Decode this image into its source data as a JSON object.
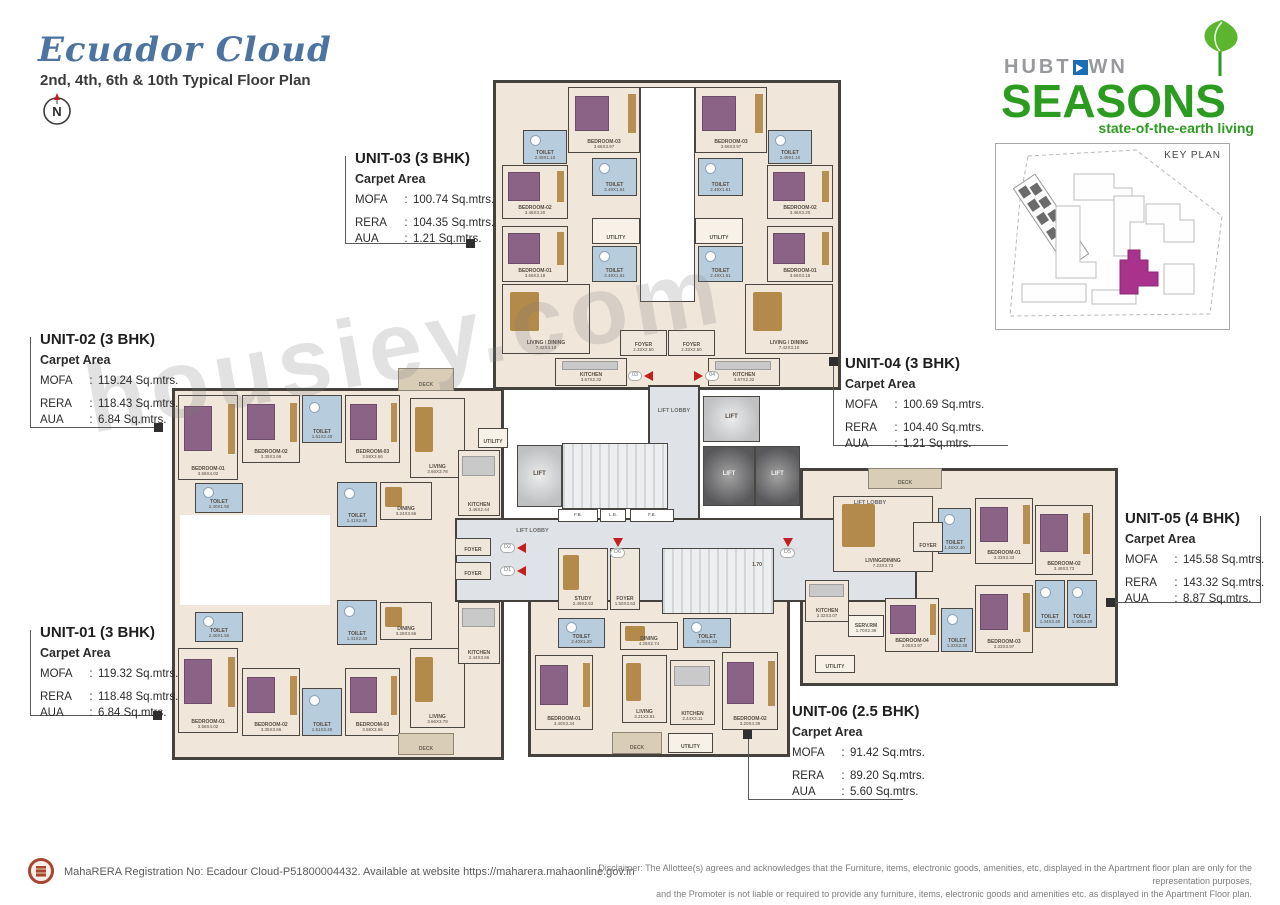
{
  "header": {
    "title": "Ecuador Cloud",
    "subtitle": "2nd, 4th, 6th & 10th Typical Floor Plan",
    "compass": "N"
  },
  "logo": {
    "brand": "HUBT",
    "brand2": "WN",
    "product": "SEASONS",
    "tagline": "state-of-the-earth living"
  },
  "keyplan": {
    "label": "KEY PLAN"
  },
  "watermark": "housiey.com",
  "units": [
    {
      "id": "unit-01",
      "name": "UNIT-01 (3 BHK)",
      "carpet": "Carpet Area",
      "rows": [
        [
          "MOFA",
          "119.32 Sq.mtrs."
        ],
        [
          "RERA",
          "118.48 Sq.mtrs."
        ],
        [
          "AUA",
          "6.84 Sq.mtrs."
        ]
      ],
      "x": 40,
      "y": 624,
      "lines": [
        [
          30,
          630,
          1,
          86
        ],
        [
          30,
          715,
          128,
          1
        ]
      ],
      "marker": [
        153,
        711
      ]
    },
    {
      "id": "unit-02",
      "name": "UNIT-02 (3 BHK)",
      "carpet": "Carpet Area",
      "rows": [
        [
          "MOFA",
          "119.24 Sq.mtrs."
        ],
        [
          "RERA",
          "118.43 Sq.mtrs."
        ],
        [
          "AUA",
          "6.84 Sq.mtrs."
        ]
      ],
      "x": 40,
      "y": 331,
      "lines": [
        [
          30,
          337,
          1,
          91
        ],
        [
          30,
          427,
          129,
          1
        ]
      ],
      "marker": [
        154,
        423
      ]
    },
    {
      "id": "unit-03",
      "name": "UNIT-03 (3 BHK)",
      "carpet": "Carpet Area",
      "rows": [
        [
          "MOFA",
          "100.74 Sq.mtrs."
        ],
        [
          "RERA",
          "104.35 Sq.mtrs."
        ],
        [
          "AUA",
          "1.21 Sq.mtrs."
        ]
      ],
      "x": 355,
      "y": 150,
      "lines": [
        [
          345,
          156,
          1,
          88
        ],
        [
          345,
          243,
          125,
          1
        ]
      ],
      "marker": [
        466,
        239
      ]
    },
    {
      "id": "unit-04",
      "name": "UNIT-04 (3 BHK)",
      "carpet": "Carpet Area",
      "rows": [
        [
          "MOFA",
          "100.69 Sq.mtrs."
        ],
        [
          "RERA",
          "104.40 Sq.mtrs."
        ],
        [
          "AUA",
          "1.21 Sq.mtrs."
        ]
      ],
      "x": 845,
      "y": 355,
      "lines": [
        [
          833,
          362,
          1,
          84
        ],
        [
          833,
          445,
          175,
          1
        ]
      ],
      "marker": [
        829,
        357
      ]
    },
    {
      "id": "unit-05",
      "name": "UNIT-05 (4 BHK)",
      "carpet": "Carpet Area",
      "rows": [
        [
          "MOFA",
          "145.58 Sq.mtrs."
        ],
        [
          "RERA",
          "143.32 Sq.mtrs."
        ],
        [
          "AUA",
          "8.87 Sq.mtrs."
        ]
      ],
      "x": 1125,
      "y": 510,
      "lines": [
        [
          1260,
          516,
          1,
          87
        ],
        [
          1112,
          602,
          149,
          1
        ]
      ],
      "marker": [
        1106,
        598
      ]
    },
    {
      "id": "unit-06",
      "name": "UNIT-06 (2.5 BHK)",
      "carpet": "Carpet Area",
      "rows": [
        [
          "MOFA",
          "91.42 Sq.mtrs."
        ],
        [
          "RERA",
          "89.20 Sq.mtrs."
        ],
        [
          "AUA",
          "5.60 Sq.mtrs."
        ]
      ],
      "x": 792,
      "y": 703,
      "lines": [
        [
          748,
          737,
          1,
          63
        ],
        [
          748,
          799,
          155,
          1
        ]
      ],
      "marker": [
        743,
        730
      ]
    }
  ],
  "floorplan": {
    "plates": [
      [
        493,
        80,
        348,
        310,
        "plate"
      ],
      [
        172,
        388,
        332,
        372,
        "plate"
      ],
      [
        800,
        468,
        318,
        218,
        "plate"
      ],
      [
        528,
        595,
        262,
        162,
        "plate"
      ],
      [
        648,
        385,
        52,
        138,
        "lobby"
      ],
      [
        455,
        518,
        462,
        84,
        "lobby"
      ],
      [
        180,
        515,
        150,
        90,
        "cut"
      ]
    ],
    "rooms": [
      [
        "",
        "",
        640,
        87,
        55,
        215,
        "shaft"
      ],
      [
        "BEDROOM-03",
        "3.66X3.97",
        568,
        87,
        72,
        66,
        "bedroom"
      ],
      [
        "TOILET",
        "2.49X1.10",
        523,
        130,
        44,
        34,
        "toilet"
      ],
      [
        "BEDROOM-02",
        "3.46X3.20",
        502,
        165,
        66,
        54,
        "bedroom"
      ],
      [
        "TOILET",
        "2.49X1.61",
        592,
        158,
        45,
        38,
        "toilet"
      ],
      [
        "BEDROOM-01",
        "3.66X3.18",
        502,
        226,
        66,
        56,
        "bedroom"
      ],
      [
        "UTILITY",
        "",
        592,
        218,
        48,
        26,
        "utility"
      ],
      [
        "TOILET",
        "2.49X1.61",
        592,
        246,
        45,
        36,
        "toilet"
      ],
      [
        "LIVING / DINING",
        "7.42X3.10",
        502,
        284,
        88,
        70,
        "living"
      ],
      [
        "FOYER",
        "2.32X2.50",
        620,
        330,
        47,
        26,
        "foyer"
      ],
      [
        "KITCHEN",
        "3.67X2.32",
        555,
        358,
        72,
        28,
        "kitchen"
      ],
      [
        "BEDROOM-03",
        "3.66X3.97",
        695,
        87,
        72,
        66,
        "bedroom"
      ],
      [
        "TOILET",
        "2.49X1.10",
        768,
        130,
        44,
        34,
        "toilet"
      ],
      [
        "BEDROOM-02",
        "3.46X3.20",
        767,
        165,
        66,
        54,
        "bedroom"
      ],
      [
        "TOILET",
        "2.49X1.61",
        698,
        158,
        45,
        38,
        "toilet"
      ],
      [
        "BEDROOM-01",
        "3.66X3.18",
        767,
        226,
        66,
        56,
        "bedroom"
      ],
      [
        "UTILITY",
        "",
        695,
        218,
        48,
        26,
        "utility"
      ],
      [
        "TOILET",
        "2.49X1.61",
        698,
        246,
        45,
        36,
        "toilet"
      ],
      [
        "LIVING / DINING",
        "7.42X3.10",
        745,
        284,
        88,
        70,
        "living"
      ],
      [
        "FOYER",
        "2.32X2.50",
        668,
        330,
        47,
        26,
        "foyer"
      ],
      [
        "KITCHEN",
        "3.67X2.32",
        708,
        358,
        72,
        28,
        "kitchen"
      ],
      [
        "DECK",
        "",
        398,
        368,
        56,
        23,
        "deck"
      ],
      [
        "BEDROOM-01",
        "3.58X4.02",
        178,
        395,
        60,
        85,
        "bedroom"
      ],
      [
        "BEDROOM-02",
        "3.35X3.66",
        242,
        395,
        58,
        68,
        "bedroom"
      ],
      [
        "TOILET",
        "1.51X2.40",
        302,
        395,
        40,
        48,
        "toilet"
      ],
      [
        "BEDROOM-03",
        "3.58X3.66",
        345,
        395,
        55,
        68,
        "bedroom"
      ],
      [
        "LIVING",
        "3.66X3.78",
        410,
        398,
        55,
        80,
        "living"
      ],
      [
        "UTILITY",
        "",
        478,
        428,
        30,
        20,
        "utility"
      ],
      [
        "TOILET",
        "2.40X1.50",
        195,
        483,
        48,
        30,
        "toilet"
      ],
      [
        "TOILET",
        "1.41X2.40",
        337,
        482,
        40,
        45,
        "toilet"
      ],
      [
        "DINING",
        "3.24X3.66",
        380,
        482,
        52,
        38,
        "living"
      ],
      [
        "KITCHEN",
        "3.46X2.44",
        458,
        450,
        42,
        66,
        "kitchen"
      ],
      [
        "FOYER",
        "",
        455,
        538,
        36,
        18,
        "foyer"
      ],
      [
        "FOYER",
        "",
        455,
        562,
        36,
        18,
        "foyer"
      ],
      [
        "BEDROOM-01",
        "3.58X4.02",
        178,
        648,
        60,
        85,
        "bedroom"
      ],
      [
        "BEDROOM-02",
        "3.35X3.66",
        242,
        668,
        58,
        68,
        "bedroom"
      ],
      [
        "TOILET",
        "1.51X2.40",
        302,
        688,
        40,
        48,
        "toilet"
      ],
      [
        "BEDROOM-03",
        "3.58X3.66",
        345,
        668,
        55,
        68,
        "bedroom"
      ],
      [
        "LIVING",
        "3.66X3.78",
        410,
        648,
        55,
        80,
        "living"
      ],
      [
        "DECK",
        "",
        398,
        733,
        56,
        22,
        "deck"
      ],
      [
        "TOILET",
        "2.40X1.50",
        195,
        612,
        48,
        30,
        "toilet"
      ],
      [
        "TOILET",
        "1.41X2.40",
        337,
        600,
        40,
        45,
        "toilet"
      ],
      [
        "DINING",
        "3.28X3.66",
        380,
        602,
        52,
        38,
        "living"
      ],
      [
        "KITCHEN",
        "2.44X3.66",
        458,
        602,
        42,
        62,
        "kitchen"
      ],
      [
        "DECK",
        "",
        868,
        468,
        74,
        21,
        "deck"
      ],
      [
        "LIVING/DINING",
        "7.23X3.73",
        833,
        496,
        100,
        76,
        "living"
      ],
      [
        "TOILET",
        "1.48X2.40",
        938,
        508,
        33,
        46,
        "toilet"
      ],
      [
        "BEDROOM-01",
        "3.33X3.33",
        975,
        498,
        58,
        66,
        "bedroom"
      ],
      [
        "BEDROOM-02",
        "3.48X3.73",
        1035,
        505,
        58,
        70,
        "bedroom"
      ],
      [
        "KITCHEN",
        "2.32X3.07",
        805,
        580,
        44,
        42,
        "kitchen"
      ],
      [
        "SERV.RM",
        "1.70X2.39",
        848,
        615,
        36,
        22,
        "utility"
      ],
      [
        "BEDROOM-04",
        "3.05X3.97",
        885,
        598,
        54,
        54,
        "bedroom"
      ],
      [
        "TOILET",
        "1.33X2.38",
        941,
        608,
        32,
        44,
        "toilet"
      ],
      [
        "BEDROOM-03",
        "3.33X3.97",
        975,
        585,
        58,
        68,
        "bedroom"
      ],
      [
        "TOILET",
        "1.44X2.40",
        1035,
        580,
        30,
        48,
        "toilet"
      ],
      [
        "TOILET",
        "1.40X2.40",
        1067,
        580,
        30,
        48,
        "toilet"
      ],
      [
        "UTILITY",
        "",
        815,
        655,
        40,
        18,
        "utility"
      ],
      [
        "FOYER",
        "",
        913,
        522,
        30,
        30,
        "foyer"
      ],
      [
        "STUDY",
        "2.49X2.63",
        558,
        548,
        50,
        62,
        "living"
      ],
      [
        "FOYER",
        "1.50X3.63",
        610,
        548,
        30,
        62,
        "foyer"
      ],
      [
        "TOILET",
        "2.40X1.20",
        558,
        618,
        47,
        30,
        "toilet"
      ],
      [
        "DINING",
        "4.25X2.74",
        620,
        622,
        58,
        28,
        "living"
      ],
      [
        "TOILET",
        "2.40X1.33",
        683,
        618,
        48,
        30,
        "toilet"
      ],
      [
        "BEDROOM-01",
        "3.40X3.34",
        535,
        655,
        58,
        75,
        "bedroom"
      ],
      [
        "LIVING",
        "3.21X3.81",
        622,
        655,
        45,
        68,
        "living"
      ],
      [
        "KITCHEN",
        "2.44X3.11",
        670,
        660,
        45,
        65,
        "kitchen"
      ],
      [
        "BEDROOM-02",
        "3.20X4.39",
        722,
        652,
        56,
        78,
        "bedroom"
      ],
      [
        "DECK",
        "",
        612,
        732,
        50,
        22,
        "deck"
      ],
      [
        "UTILITY",
        "",
        668,
        733,
        45,
        20,
        "utility"
      ],
      [
        "LIFT",
        "",
        517,
        445,
        45,
        62,
        "lift"
      ],
      [
        "LIFT",
        "",
        703,
        396,
        57,
        46,
        "lift"
      ],
      [
        "LIFT",
        "",
        703,
        446,
        52,
        60,
        "liftdark"
      ],
      [
        "LIFT",
        "",
        755,
        446,
        45,
        60,
        "liftdark"
      ],
      [
        "1.70",
        "",
        743,
        551,
        28,
        30,
        "servlift"
      ],
      [
        "",
        "",
        562,
        443,
        106,
        66,
        "stair"
      ],
      [
        "",
        "",
        662,
        548,
        112,
        66,
        "stair"
      ],
      [
        "F.B.",
        "",
        558,
        509,
        40,
        13,
        "fb"
      ],
      [
        "L.B.",
        "",
        600,
        509,
        26,
        13,
        "fb"
      ],
      [
        "F.B.",
        "",
        630,
        509,
        44,
        13,
        "fb"
      ],
      [
        "LIFT LOBBY",
        "",
        648,
        405,
        52,
        14,
        "lobbylabel"
      ],
      [
        "LIFT LOBBY",
        "",
        505,
        526,
        55,
        12,
        "lobbylabel"
      ],
      [
        "LIFT LOBBY",
        "",
        840,
        498,
        60,
        12,
        "lobbylabel"
      ]
    ],
    "doors": [
      [
        628,
        371,
        "left",
        "03"
      ],
      [
        694,
        371,
        "right",
        "04"
      ],
      [
        500,
        543,
        "left",
        "D2"
      ],
      [
        500,
        566,
        "left",
        "D1"
      ],
      [
        610,
        538,
        "down",
        "D6"
      ],
      [
        780,
        538,
        "down",
        "D5"
      ]
    ]
  },
  "footer": {
    "rera": "MahaRERA Registration No: Ecadour Cloud-P51800004432. Available at website https://maharera.mahaonline.gov.in",
    "disclaimer1": "Disclaimer: The Allottee(s) agrees and acknowledges that the Furniture, items, electronic goods, amenities, etc, displayed in the Apartment floor plan are only for the representation purposes,",
    "disclaimer2": "and the Promoter is not liable or required to provide any furniture, items, electronic goods and amenities etc. as displayed in the Apartment Floor plan."
  }
}
